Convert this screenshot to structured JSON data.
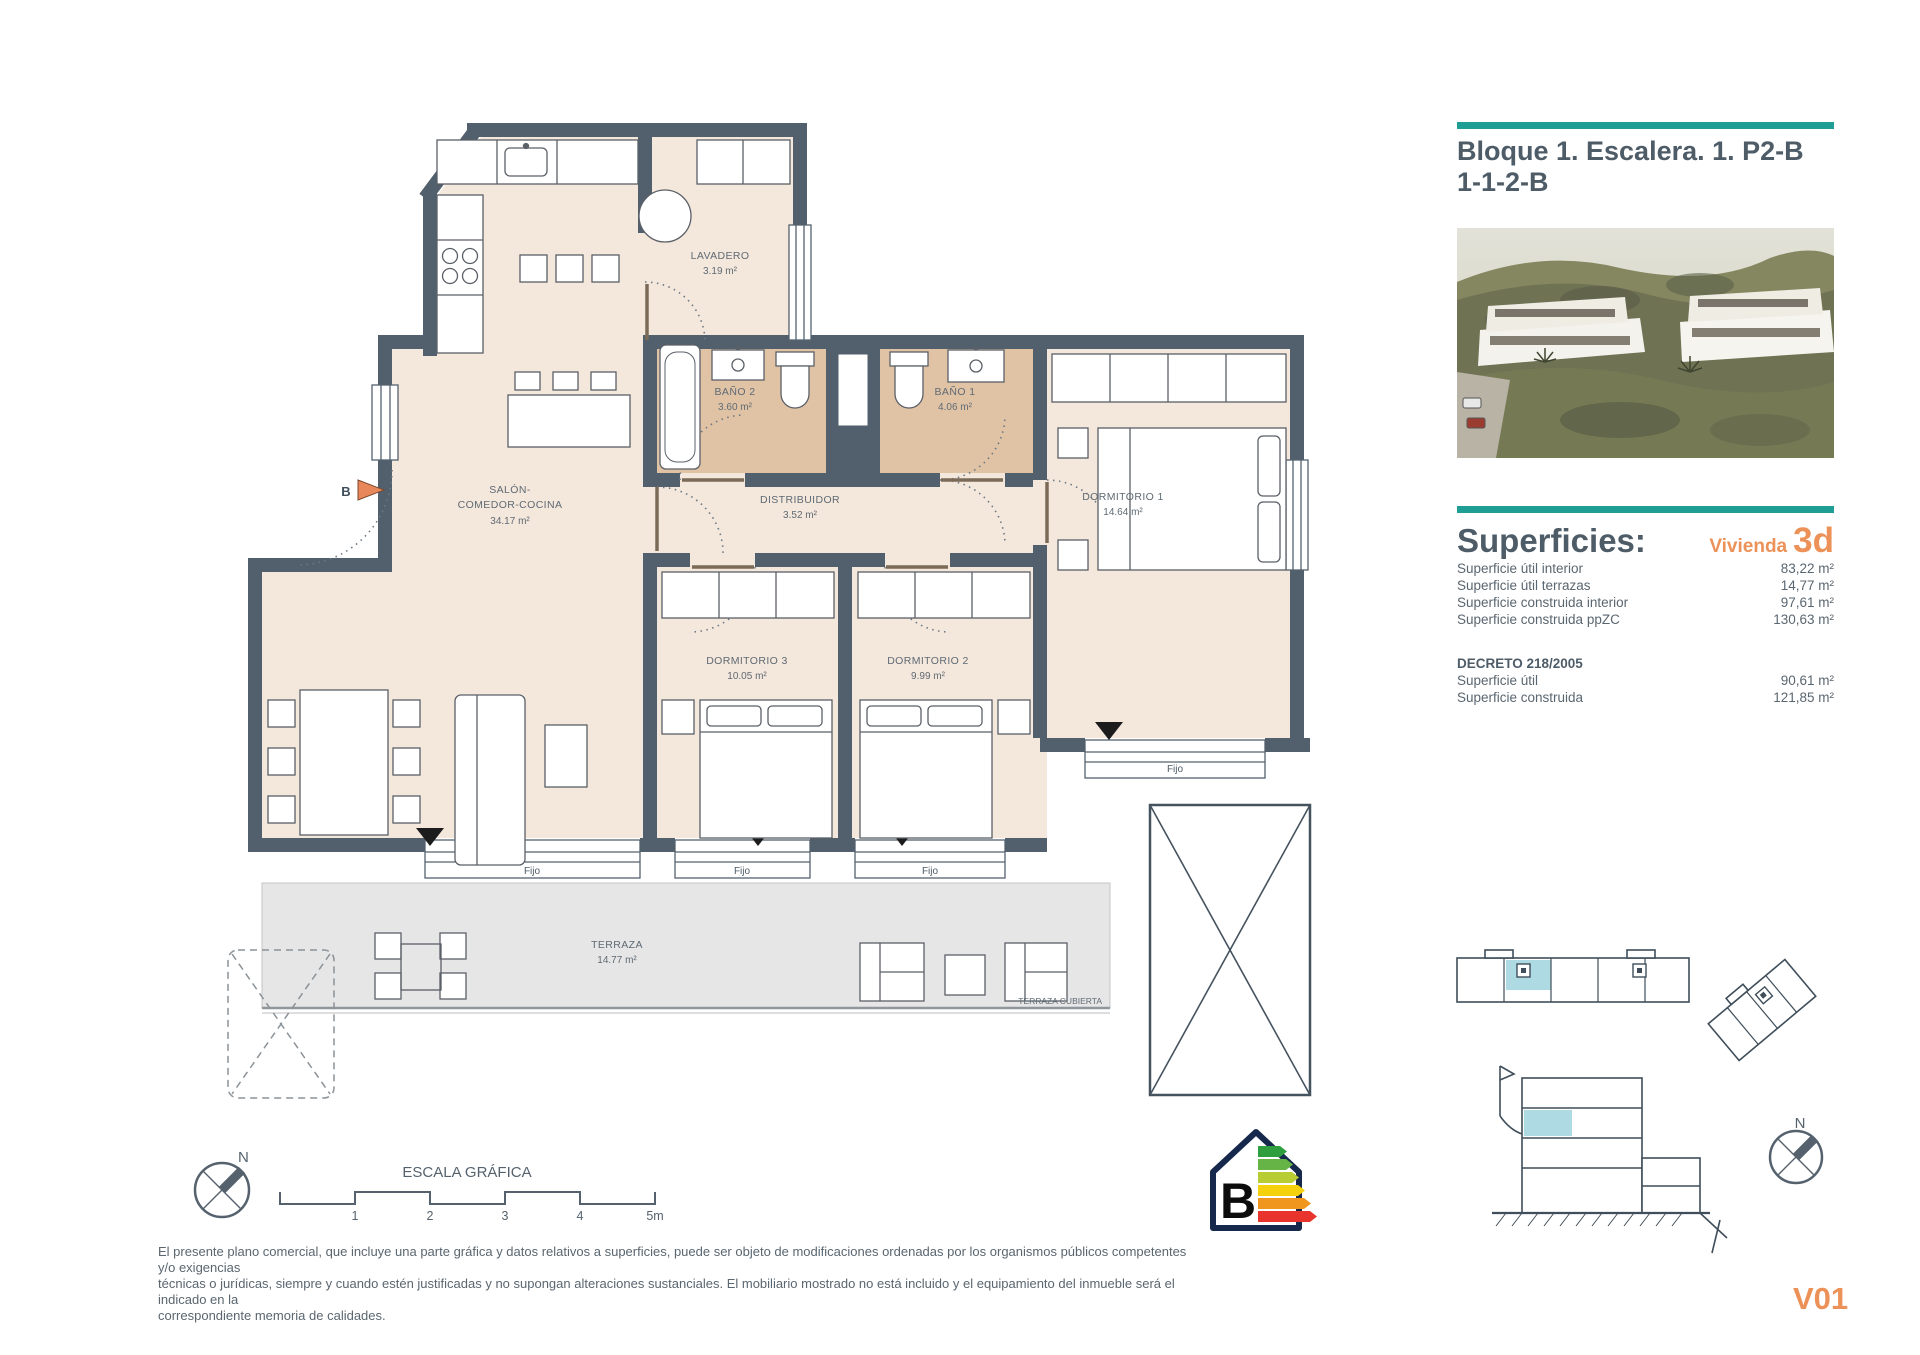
{
  "colors": {
    "teal": "#1f9e95",
    "orange": "#ec9157",
    "slate_text": "#55626e",
    "wall": "#51606c",
    "floor": "#f4e7dc",
    "bath_floor": "#e0c3a5",
    "terrace": "#e6e6e6",
    "highlight_unit": "#aedbe3"
  },
  "panel": {
    "title_line1": "Bloque 1. Escalera. 1. P2-B",
    "title_line2": "1-1-2-B",
    "superficies_heading": "Superficies:",
    "vivienda_label": "Vivienda",
    "vivienda_type": "3d",
    "rows": [
      {
        "label": "Superficie útil interior",
        "value": "83,22 m²"
      },
      {
        "label": "Superficie útil terrazas",
        "value": "14,77 m²"
      },
      {
        "label": "Superficie construida interior",
        "value": "97,61 m²"
      },
      {
        "label": "Superficie construida ppZC",
        "value": "130,63 m²"
      }
    ],
    "decreto_heading": "DECRETO 218/2005",
    "decreto_rows": [
      {
        "label": "Superficie útil",
        "value": "90,61 m²"
      },
      {
        "label": "Superficie construida",
        "value": "121,85 m²"
      }
    ],
    "unit_code": "V01"
  },
  "plan": {
    "section_marker": "B",
    "window_label": "Fijo",
    "north_label": "N",
    "rooms": {
      "lavadero": {
        "name": "LAVADERO",
        "area": "3.19 m²"
      },
      "bano2": {
        "name": "BAÑO 2",
        "area": "3.60 m²"
      },
      "bano1": {
        "name": "BAÑO 1",
        "area": "4.06 m²"
      },
      "salon": {
        "name1": "SALÓN-",
        "name2": "COMEDOR-COCINA",
        "area": "34.17 m²"
      },
      "distribuidor": {
        "name": "DISTRIBUIDOR",
        "area": "3.52 m²"
      },
      "dormitorio1": {
        "name": "DORMITORIO 1",
        "area": "14.64 m²"
      },
      "dormitorio2": {
        "name": "DORMITORIO 2",
        "area": "9.99 m²"
      },
      "dormitorio3": {
        "name": "DORMITORIO 3",
        "area": "10.05 m²"
      },
      "terraza": {
        "name": "TERRAZA",
        "area": "14.77 m²"
      },
      "terraza_cubierta": "TERRAZA CUBIERTA"
    },
    "scale": {
      "title": "ESCALA GRÁFICA",
      "ticks": [
        "1",
        "2",
        "3",
        "4",
        "5m"
      ]
    }
  },
  "energy": {
    "rating": "B"
  },
  "footer": {
    "line1": "El presente plano comercial, que incluye una parte gráfica y datos relativos a superficies, puede ser objeto de modificaciones ordenadas por los organismos públicos competentes y/o exigencias",
    "line2": "técnicas o jurídicas, siempre y cuando estén justificadas y no supongan alteraciones sustanciales. El mobiliario mostrado no está incluido y el equipamiento del inmueble será el indicado en la",
    "line3": "correspondiente memoria de calidades."
  }
}
